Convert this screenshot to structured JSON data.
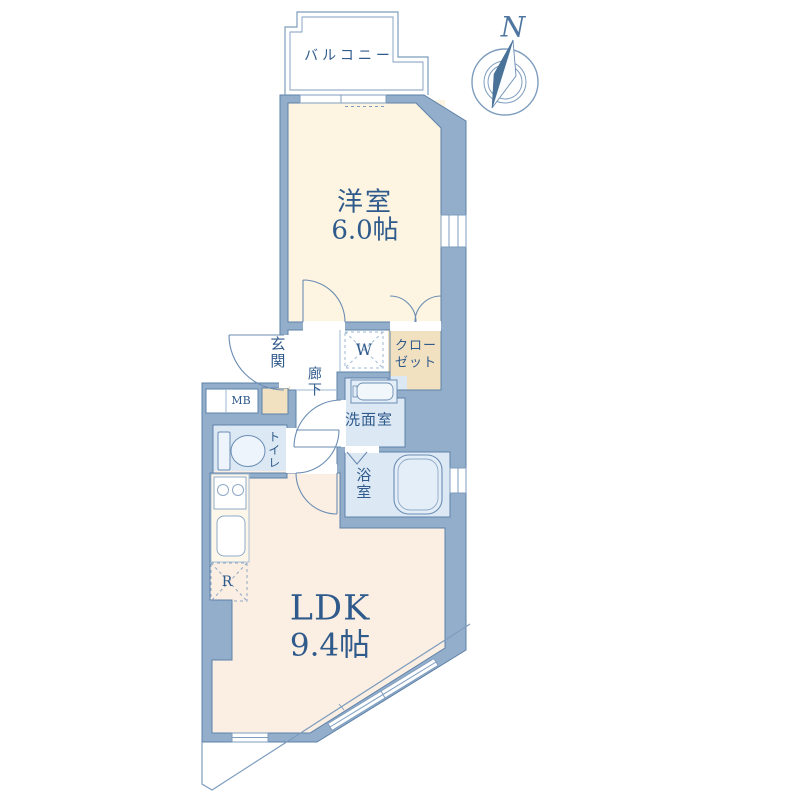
{
  "floor_plan": {
    "compass": {
      "north_label": "N"
    },
    "balcony": {
      "label": "バルコニー"
    },
    "western_room": {
      "name": "洋室",
      "size": "6.0帖"
    },
    "closet": {
      "line1": "クロー",
      "line2": "ゼット"
    },
    "washer_space": {
      "label": "W"
    },
    "entrance": {
      "label": "玄関"
    },
    "hallway": {
      "label": "廊下"
    },
    "meter_box": {
      "label": "MB"
    },
    "toilet": {
      "label": "トイレ"
    },
    "washroom": {
      "label": "洗面室"
    },
    "bathroom": {
      "label": "浴室"
    },
    "ldk": {
      "name": "LDK",
      "size": "9.4帖"
    },
    "refrigerator_space": {
      "label": "R"
    },
    "colors": {
      "wall": "#93aecb",
      "wall_edge": "#5e81a8",
      "western_room_floor": "#fdf5e1",
      "ldk_floor": "#fbeee2",
      "wet_room_floor": "#dce9f4",
      "closet_floor": "#f2e1c0",
      "label_text": "#2f5a8c",
      "thin_line": "#7e9dbe"
    }
  }
}
